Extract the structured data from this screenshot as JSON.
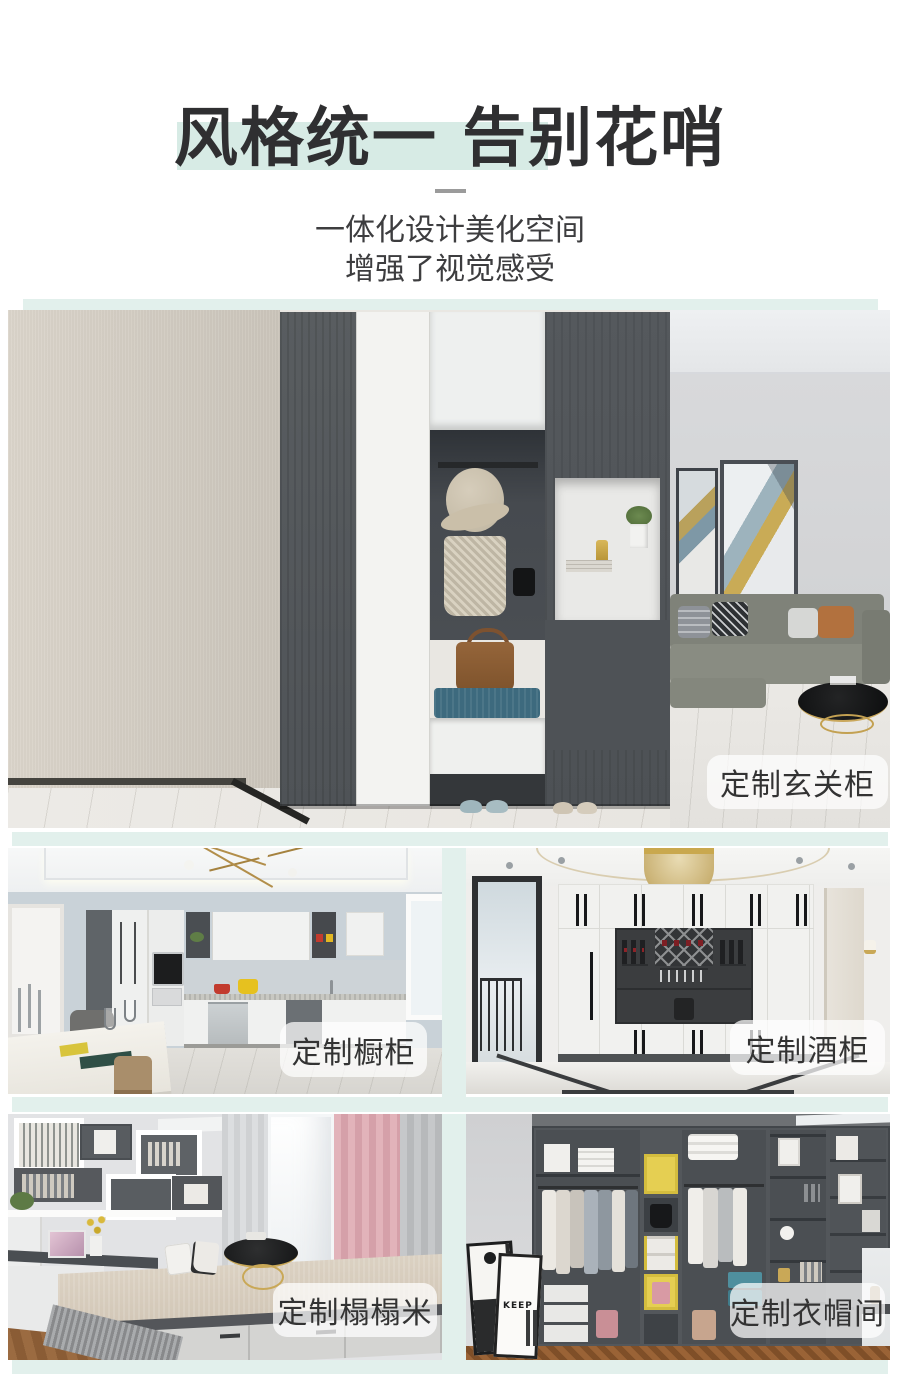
{
  "header": {
    "title": "风格统一 告别花哨",
    "subtitle1": "一体化设计美化空间",
    "subtitle2": "增强了视觉感受"
  },
  "cards": {
    "hero": {
      "label": "定制玄关柜",
      "scene": "entryway-cabinet-room"
    },
    "kitchen": {
      "label": "定制橱柜",
      "scene": "kitchen-cabinets-room"
    },
    "wine": {
      "label": "定制酒柜",
      "scene": "wine-cabinet-room"
    },
    "tatami": {
      "label": "定制榻榻米",
      "scene": "tatami-study-room"
    },
    "wardrobe": {
      "label": "定制衣帽间",
      "scene": "walk-in-closet-room",
      "poster_text": "KEEP"
    }
  },
  "colors": {
    "mint": "#e2f0ec",
    "highlight": "#d7ebe5",
    "title_color": "#2f2f31",
    "subtitle_color": "#3d3d3f",
    "label_bg": "rgba(255,255,255,0.72)",
    "label_text": "#333333"
  }
}
